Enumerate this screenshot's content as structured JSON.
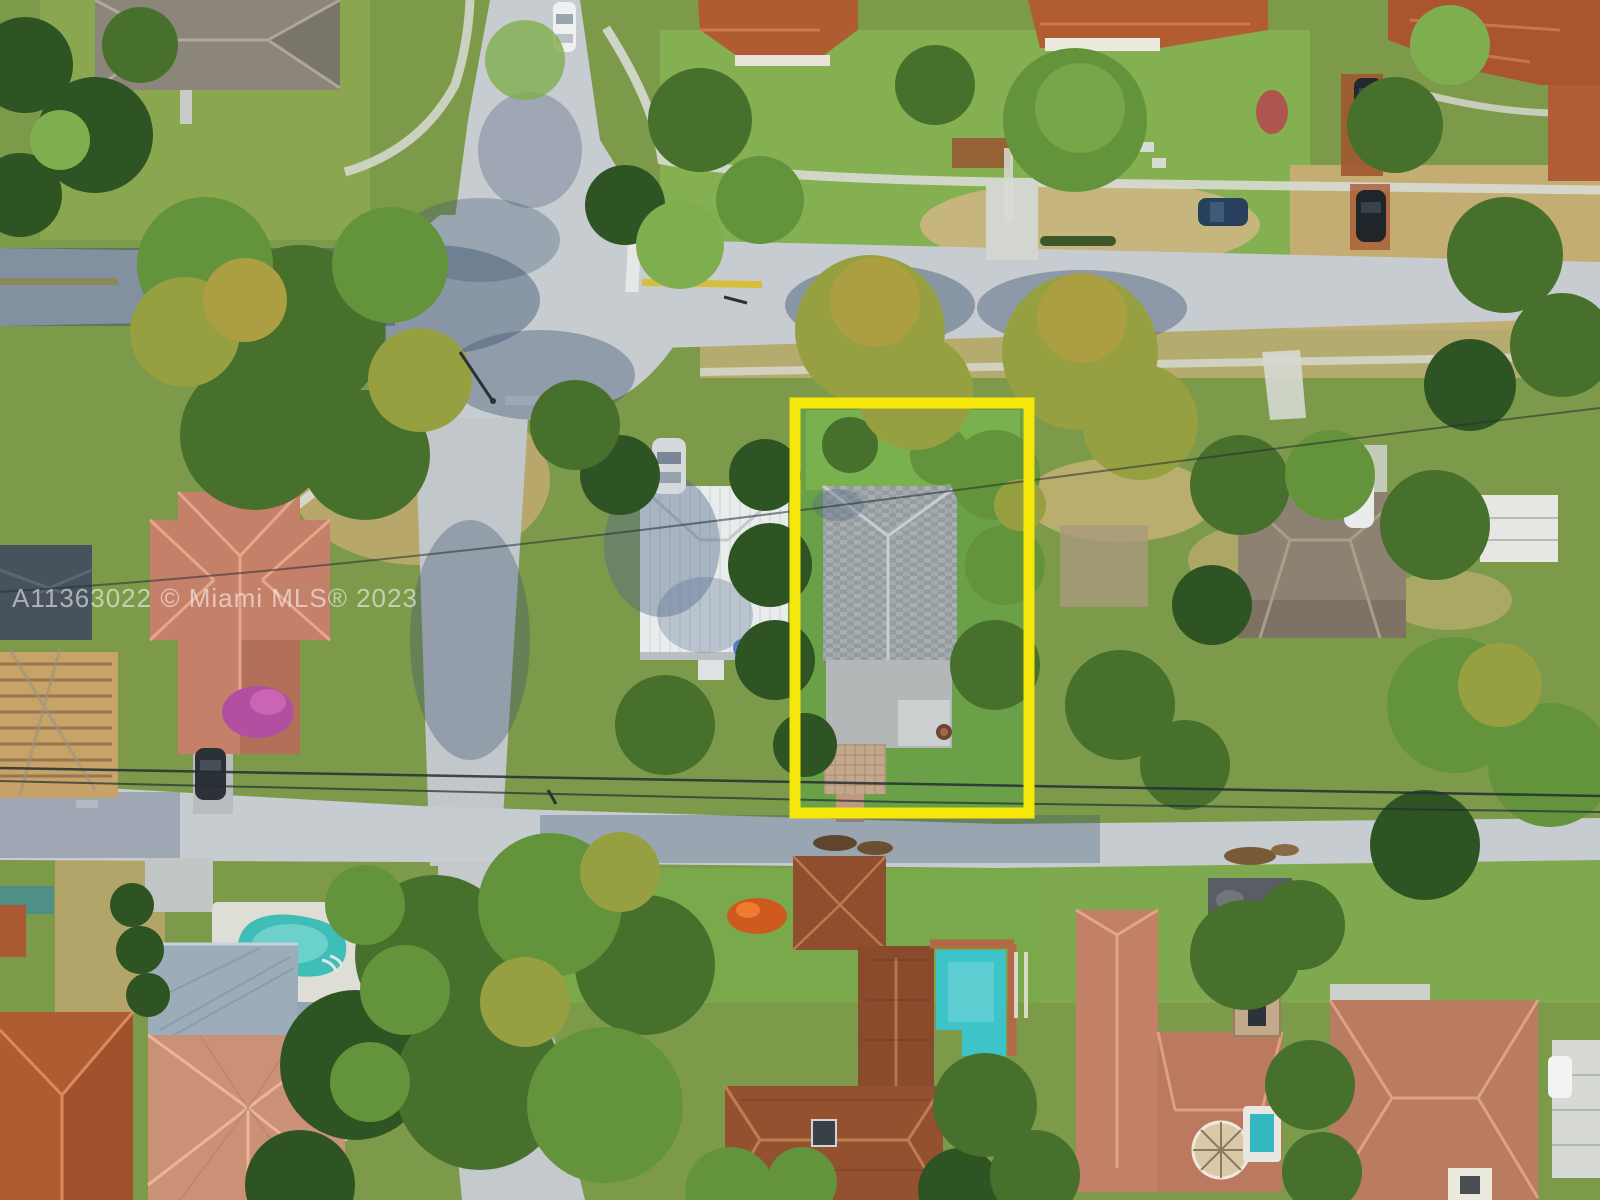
{
  "meta": {
    "kind": "aerial-listing-photo"
  },
  "watermark": {
    "text": "A11363022 © Miami MLS® 2023",
    "color": "#ffffff",
    "opacity": 0.55,
    "font_size": 26
  },
  "highlight_box": {
    "x": 795,
    "y": 403,
    "width": 234,
    "height": 410,
    "stroke": "#F6E70B",
    "stroke_width": 11
  },
  "palette": {
    "ground": "#7d9a4a",
    "lawn_bright": "#84b052",
    "dry_grass": "#c3b078",
    "asphalt": "#c7ccd0",
    "asphalt_shadow": "#3e5470",
    "sidewalk": "#d8dbd4",
    "power_line": "#242e33",
    "pool_water": "#3fbdb7",
    "pool_water_alt": "#3ec3c9",
    "roof_gray_shingle": "#9fa5a8",
    "roof_white_metal": "#e9ecec",
    "roof_tile_orange": "#b05c32",
    "roof_tile_salmon": "#c5806a",
    "roof_tile_brown": "#8f4f2e",
    "roof_flat_dark": "#585e63",
    "centerline_yellow": "#d7bf3e"
  },
  "scene_labels": {
    "subject": "subject-property-outline",
    "streets": [
      "top-street",
      "left-street",
      "right-street",
      "lower-street",
      "bottom-street"
    ],
    "pools": [
      "kidney-pool",
      "stepped-pool",
      "spa"
    ],
    "vehicles": [
      "white-car-top",
      "silver-car-center",
      "blue-car-right",
      "black-car-right-1",
      "black-car-right-2",
      "white-car-right",
      "dark-car-left"
    ]
  }
}
